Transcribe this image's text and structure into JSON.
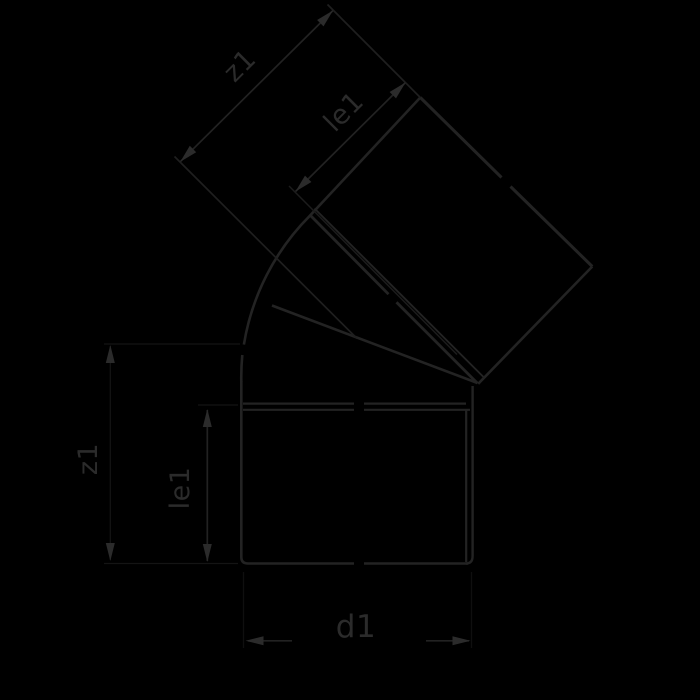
{
  "drawing": {
    "labels": {
      "z1_diagonal": "z1",
      "le1_diagonal": "le1",
      "z1_vertical": "z1",
      "le1_vertical": "le1",
      "d1": "d1"
    },
    "colors": {
      "background": "#000000",
      "outline": "#232323",
      "dimension_line": "#222222",
      "arrow_and_text": "#2b2b2b",
      "faint_construction": "#141414"
    }
  }
}
